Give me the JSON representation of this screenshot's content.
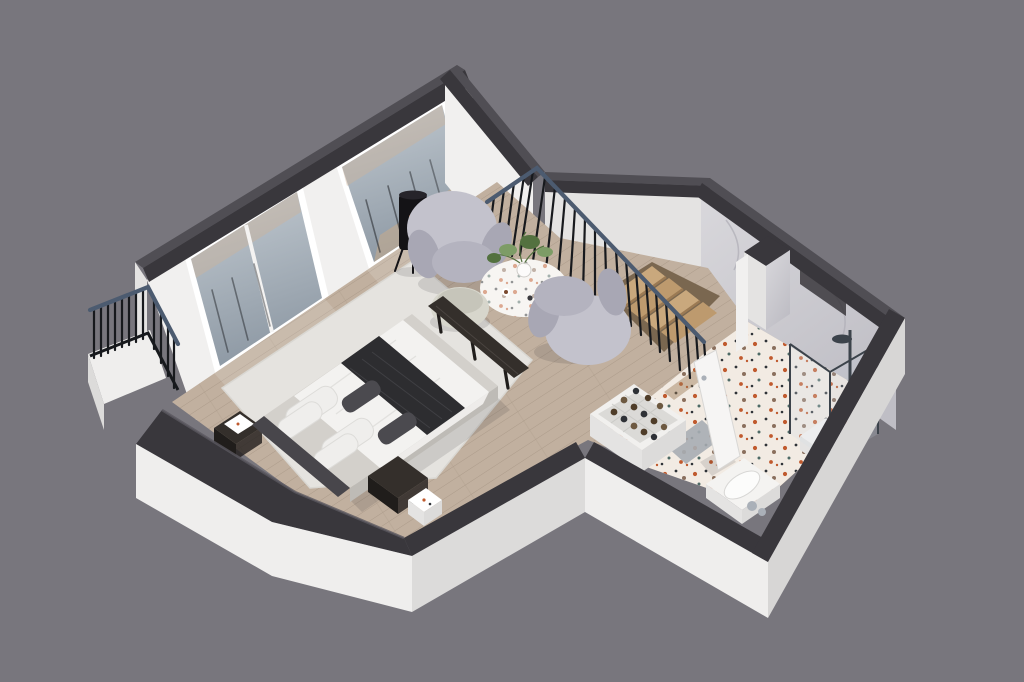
{
  "meta": {
    "kind": "3d-isometric-floorplan-render",
    "subject": "cutaway upper-floor apartment with bedroom-sitting area, stairwell and bathroom",
    "background_note": "solid gray studio backdrop, no text or UI controls visible"
  },
  "canvas": {
    "width": 1024,
    "height": 682
  },
  "palette": {
    "bg": "#78767d",
    "cap-side": "#39373c",
    "cap-top": "#504e54",
    "cap-lip": "#5a585f",
    "wall-white": "#f1f0ef",
    "wall-shade": "#e4e3e2",
    "slab-light": "#efeeed",
    "slab-mid": "#dcdbda",
    "slab-dark": "#d7d6d5",
    "wood": "#c1b09f",
    "wood-line": "#ac9b8a",
    "rug": "#e5e3df",
    "rug-edge": "#d9d7d2",
    "terrazzo": "#f2ebe3",
    "spk-orange": "#c05a2e",
    "spk-dark": "#2f3338",
    "spk-taupe": "#8a6f5d",
    "spk-teal": "#4e6a66",
    "marble": "#d9d8dc",
    "marble-lo": "#bfbec5",
    "marble-streak": "#aeadb5",
    "bar-dark": "#17191d",
    "handrail": "#4c5b70",
    "tread": "#c9a87d",
    "tread-alt": "#bd9a6e",
    "riser": "#9b7a54",
    "void": "#7a6750",
    "stringer": "#eceebea",
    "chair-main": "#c3c2cc",
    "chair-shade": "#a8a7b4",
    "chair-seat": "#b4b3bf",
    "pouf": "#d7d6cc",
    "pouf-shade": "#c6c5ba",
    "table-top": "#f7f5f2",
    "plant": "#7d9c66",
    "plant-dark": "#53713f",
    "lamp-black": "#141316",
    "lamp-glow": "#c47038",
    "platform": "#d3d0cb",
    "platform-side": "#bebbb6",
    "duvet": "#f3f2f0",
    "duvet-fold": "#dddcd9",
    "throw-dark": "#2d2d30",
    "throw-line": "#47474b",
    "pillow-white": "#efeeec",
    "cushion": "#4b4a4f",
    "headboard": "#48464b",
    "wood-furn": "#342f2b",
    "wood-furn-dark": "#201d1b",
    "door-white": "#f6f5f4",
    "door-edge": "#d8d7d5",
    "chrome": "#aab0b8",
    "basin": "#fcfcfb",
    "vanity": "#f4f3f1",
    "rack-white": "#f1f0ee",
    "rack-inner": "#dbdad7",
    "rack-grid": "#c6c5c2",
    "bottle-a": "#4f3d29",
    "bottle-b": "#2e3136",
    "bottle-c": "#6d5941",
    "glass-hi": "#c3cbd2",
    "glass-lo": "#8f9aa5",
    "glass-frame": "#3c434b",
    "glass-panel": "#a7adb3",
    "shadow": "rgba(25,25,30,0.12)",
    "sun": "rgba(255,255,255,0.14)",
    "thru-warm": "rgba(203,180,155,0.45)",
    "thru-floor": "rgba(200,171,138,0.55)"
  },
  "rooms": [
    {
      "name": "bedroom-sitting-area",
      "floor": "wood planks with large light rug"
    },
    {
      "name": "stairwell",
      "floor": "wood stairs descending"
    },
    {
      "name": "bathroom",
      "floor": "white terrazzo with orange and dark speckles"
    },
    {
      "name": "balcony",
      "floor": "outside glass doors, black metal railing"
    }
  ],
  "objects": [
    {
      "name": "balcony-railing",
      "material": "black metal bars, slate handrail"
    },
    {
      "name": "glass-doors",
      "count": 2,
      "material": "white frames, reflective glazing"
    },
    {
      "name": "floor-lamp",
      "material": "black cylinder shade, amber filament, tripod legs"
    },
    {
      "name": "armchair",
      "count": 2,
      "material": "light gray curved upholstery"
    },
    {
      "name": "pouf",
      "material": "pale sage-gray knit"
    },
    {
      "name": "coffee-table",
      "material": "white terrazzo round top with plant and cups"
    },
    {
      "name": "stair-railing",
      "material": "black balusters with steel handrail"
    },
    {
      "name": "stairs",
      "treads_visible": 4,
      "material": "oak"
    },
    {
      "name": "bed",
      "material": "gray platform, white duvet, black throw, white pillows, dark headboard"
    },
    {
      "name": "bed-bench",
      "material": "dark wood"
    },
    {
      "name": "nightstand",
      "count": 2,
      "material": "dark wood with white trays"
    },
    {
      "name": "side-cube-table",
      "material": "white terrazzo"
    },
    {
      "name": "rug",
      "material": "ivory wool"
    },
    {
      "name": "wine-rack",
      "bottles": 13,
      "material": "white shelf box"
    },
    {
      "name": "bathroom-door",
      "state": "ajar",
      "material": "white panel, chrome handle"
    },
    {
      "name": "glass-panel",
      "material": "gray glass slab"
    },
    {
      "name": "vanity-sink",
      "material": "white counter, oval basin, chrome faucet"
    },
    {
      "name": "shower",
      "material": "framed glass enclosure, rain head on marble wall"
    },
    {
      "name": "shower-bench",
      "material": "white block"
    },
    {
      "name": "marble-column",
      "material": "gray marble with dark cap and wall niche"
    }
  ],
  "counts": {
    "stair-railing-balusters": 21,
    "balcony-railing-balusters": 12,
    "windows": 2,
    "stair-treads": 4,
    "wine-bottles": 13
  }
}
